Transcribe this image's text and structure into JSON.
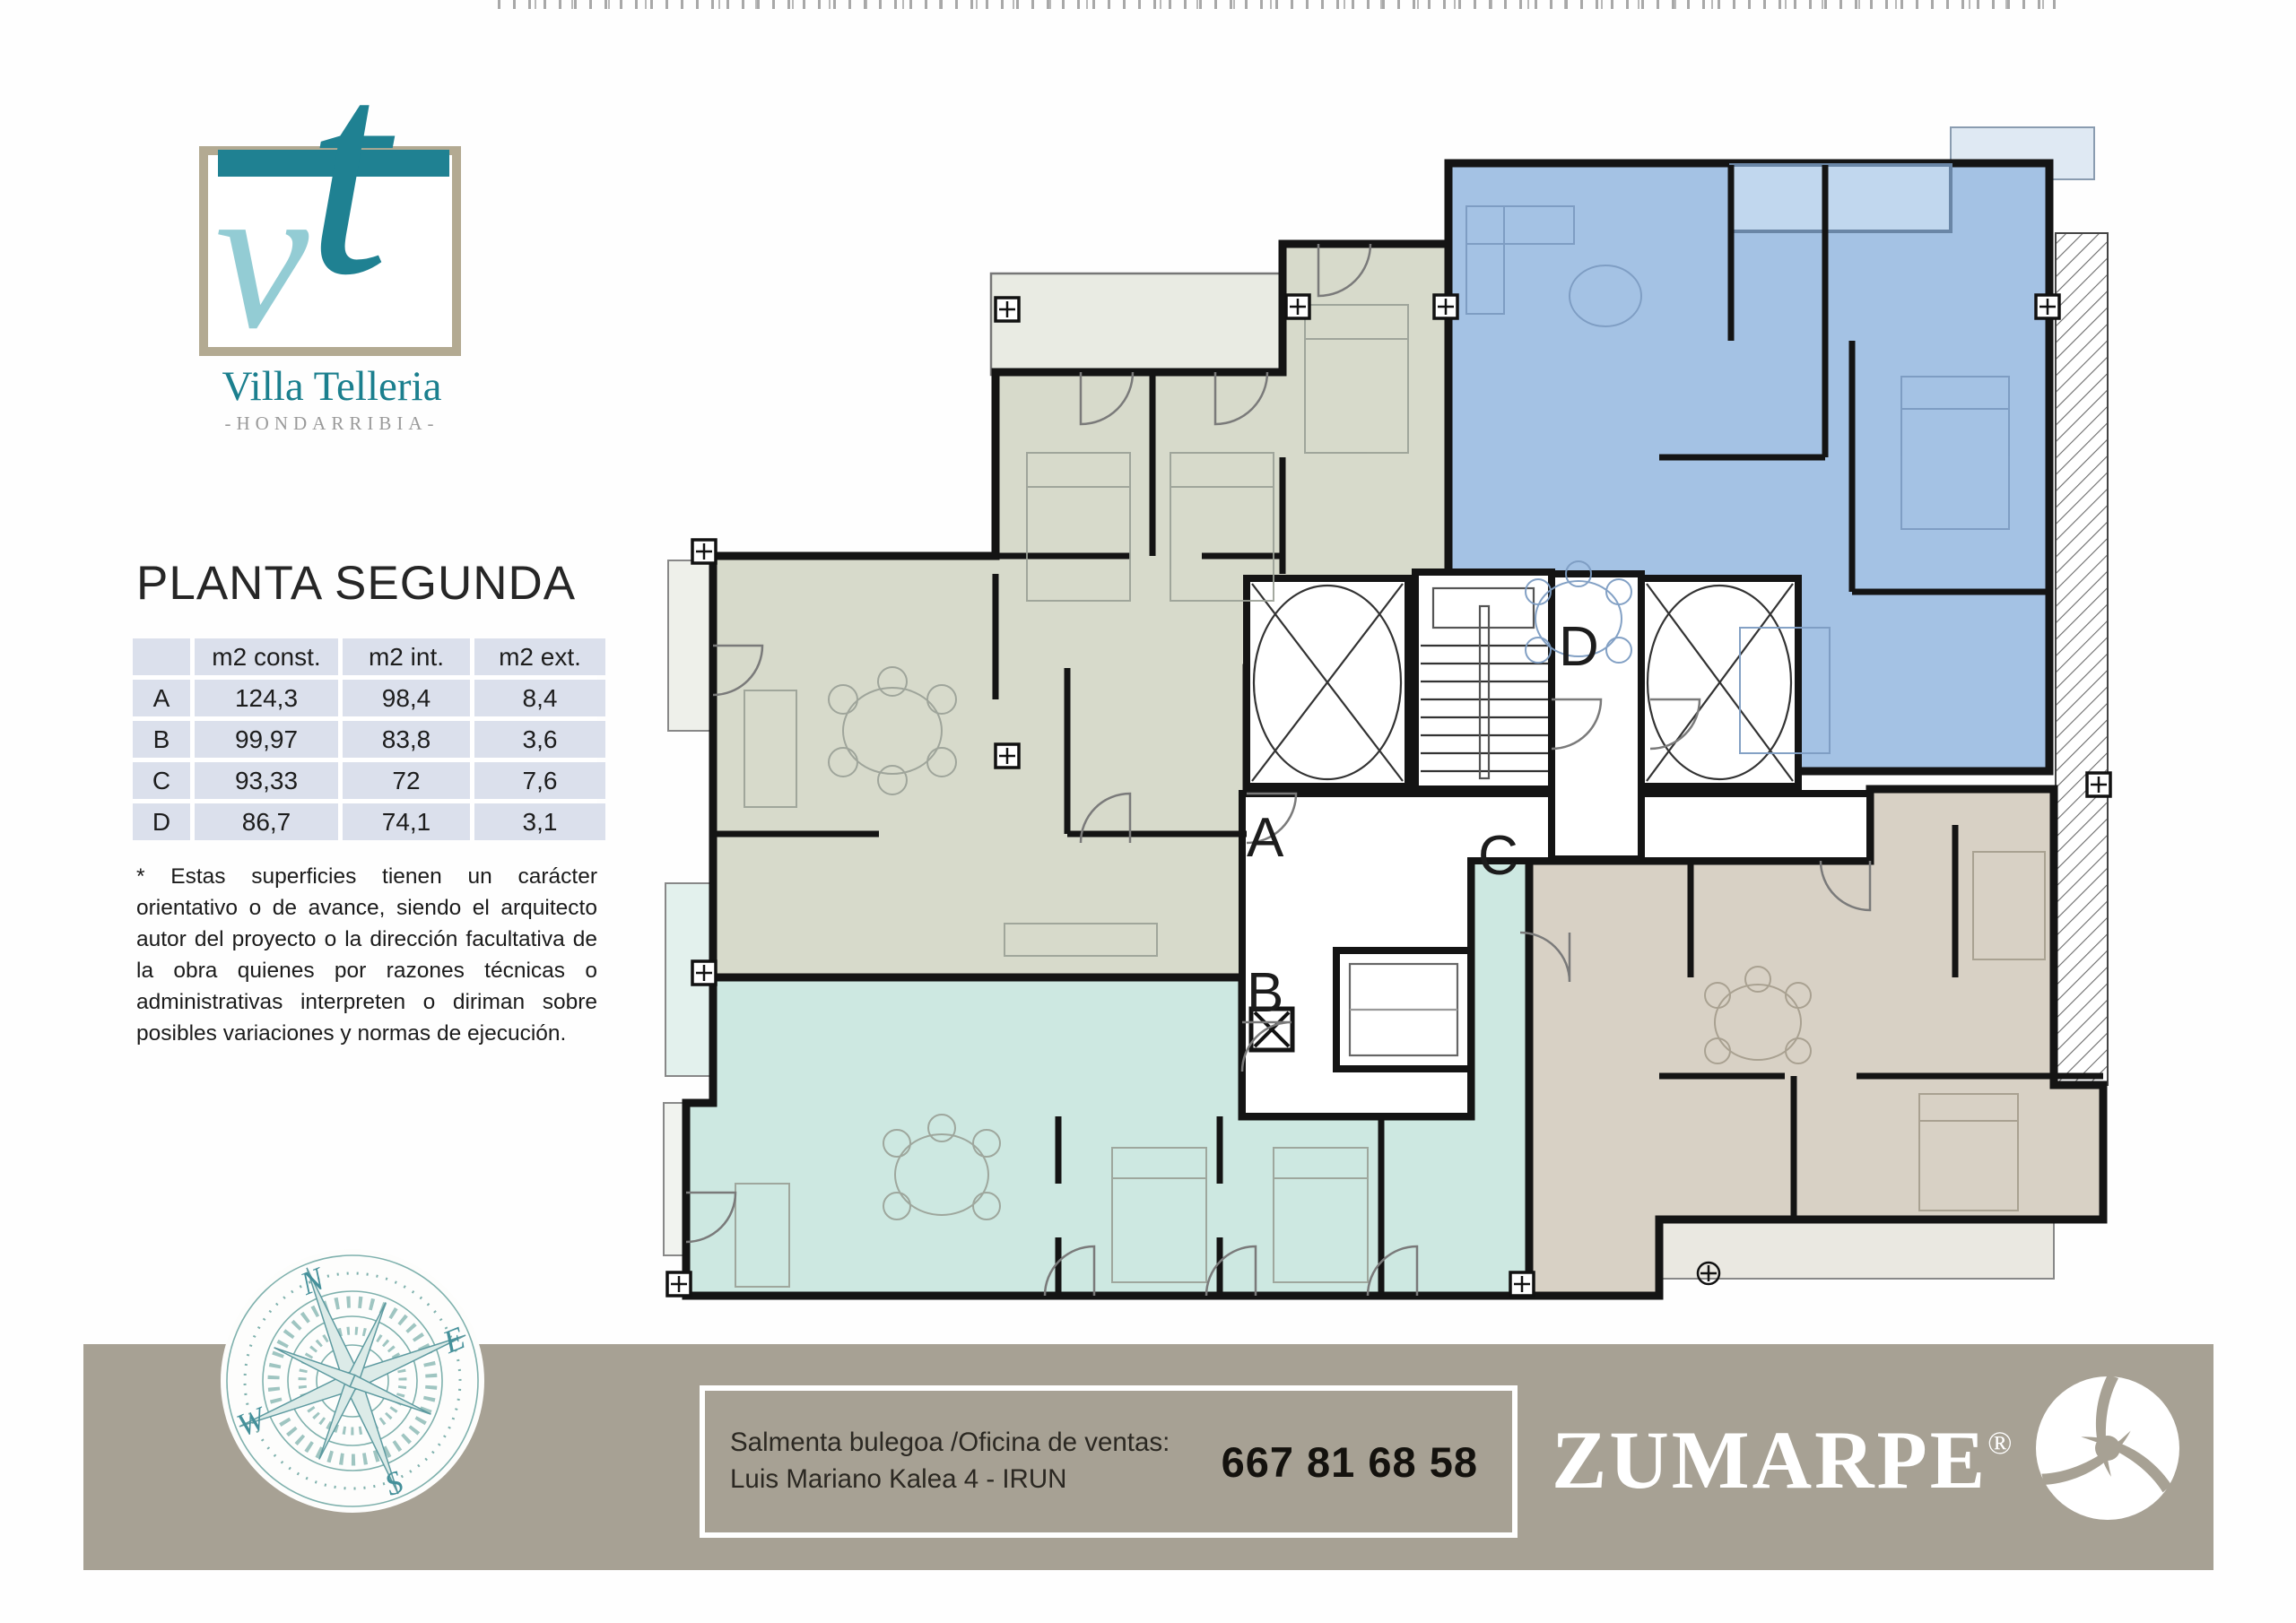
{
  "logo": {
    "letter_v": "v",
    "letter_t": "t",
    "name": "Villa Telleria",
    "subtitle": "-HONDARRIBIA-"
  },
  "plan": {
    "title": "PLANTA SEGUNDA"
  },
  "areas_table": {
    "headers": [
      "",
      "m2 const.",
      "m2 int.",
      "m2 ext."
    ],
    "rows": [
      [
        "A",
        "124,3",
        "98,4",
        "8,4"
      ],
      [
        "B",
        "99,97",
        "83,8",
        "3,6"
      ],
      [
        "C",
        "93,33",
        "72",
        "7,6"
      ],
      [
        "D",
        "86,7",
        "74,1",
        "3,1"
      ]
    ]
  },
  "disclaimer": "* Estas superficies tienen un carácter orientativo o de avance, siendo el arquitecto autor del proyecto o la dirección facultativa de la obra quienes por razones técnicas o administrativas interpreten o diriman sobre posibles variaciones y normas de ejecución.",
  "floorplan": {
    "labels": {
      "A": "A",
      "B": "B",
      "C": "C",
      "D": "D"
    },
    "unit_colors": {
      "A": "#d7dacb",
      "B": "#cde8e1",
      "C": "#d8d1c5",
      "D": "#a4c2e4"
    }
  },
  "compass": {
    "n": "N",
    "e": "E",
    "s": "S",
    "w": "W"
  },
  "footer": {
    "office_line1": "Salmenta bulegoa /Oficina de ventas:",
    "office_line2": "Luis Mariano Kalea 4 - IRUN",
    "phone": "667 81 68 58",
    "brand": "ZUMARPE",
    "registered": "®",
    "bar_color": "#a7a194"
  },
  "theme": {
    "teal_dark": "#1f8192",
    "teal_light": "#93ccd4",
    "frame_tan": "#b3aa92",
    "table_cell": "#dbe0ec"
  }
}
